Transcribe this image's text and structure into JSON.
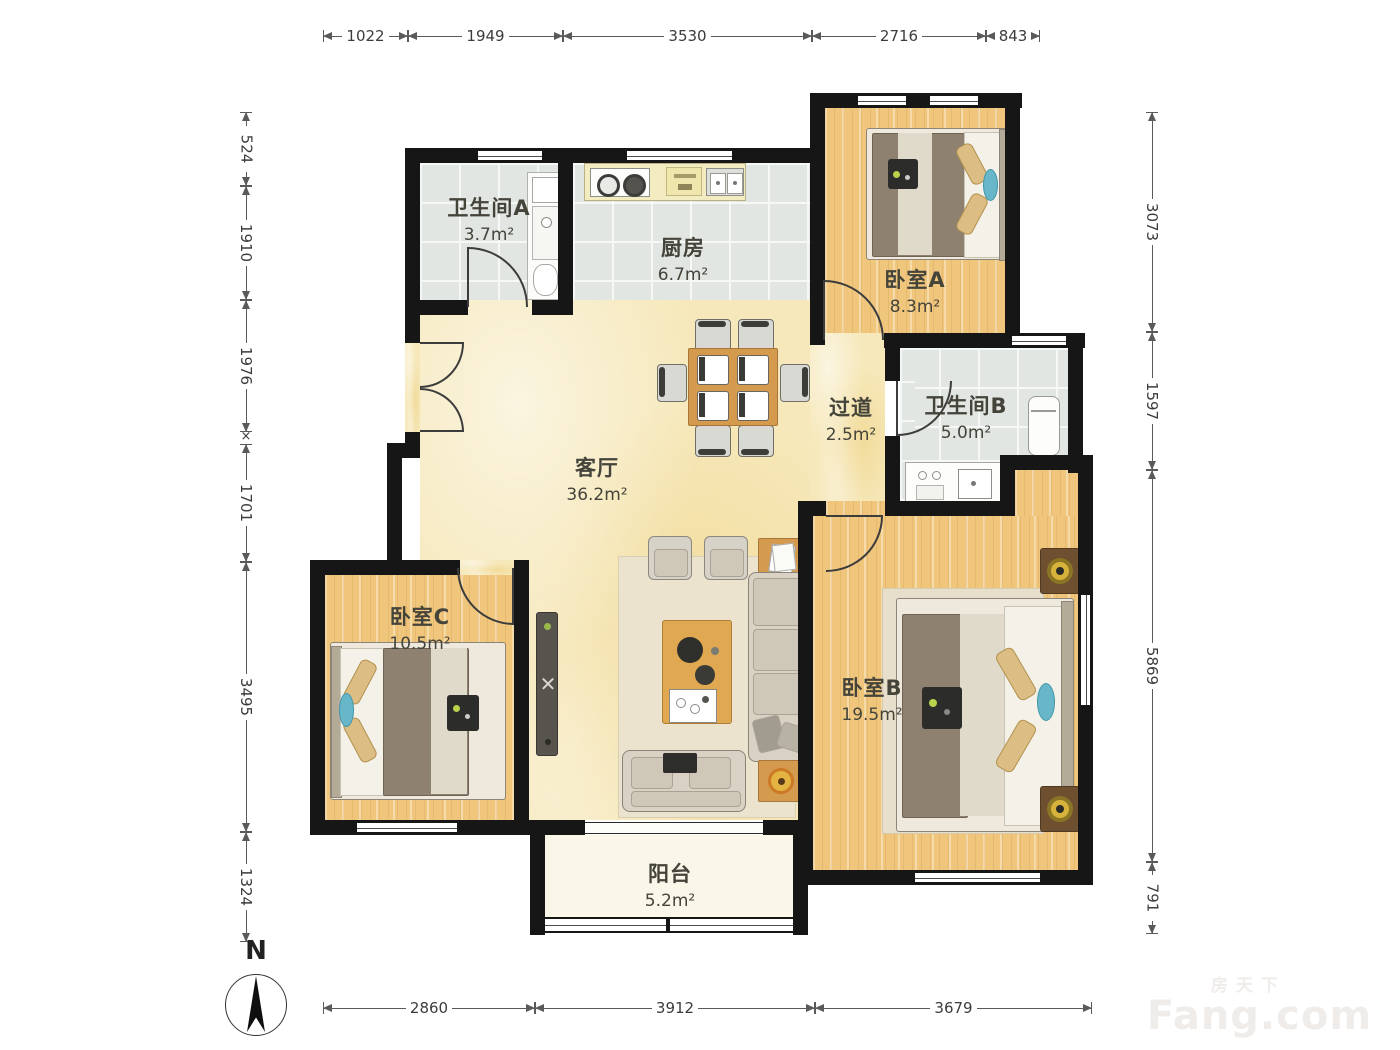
{
  "rooms": [
    {
      "id": "bathroom_a",
      "name": "卫生间A",
      "area": "3.7m²"
    },
    {
      "id": "kitchen",
      "name": "厨房",
      "area": "6.7m²"
    },
    {
      "id": "bedroom_a",
      "name": "卧室A",
      "area": "8.3m²"
    },
    {
      "id": "hallway",
      "name": "过道",
      "area": "2.5m²"
    },
    {
      "id": "bathroom_b",
      "name": "卫生间B",
      "area": "5.0m²"
    },
    {
      "id": "living_room",
      "name": "客厅",
      "area": "36.2m²"
    },
    {
      "id": "bedroom_c",
      "name": "卧室C",
      "area": "10.5m²"
    },
    {
      "id": "bedroom_b",
      "name": "卧室B",
      "area": "19.5m²"
    },
    {
      "id": "balcony",
      "name": "阳台",
      "area": "5.2m²"
    }
  ],
  "dimensions": {
    "top": [
      "1022",
      "1949",
      "3530",
      "2716",
      "843"
    ],
    "left": [
      "524",
      "1910",
      "1976",
      "1701",
      "3495",
      "1324"
    ],
    "right": [
      "3073",
      "1597",
      "5869",
      "791"
    ],
    "bottom": [
      "2860",
      "3912",
      "3679"
    ],
    "x_mark": "×"
  },
  "compass": {
    "label": "N"
  },
  "watermark": {
    "brand_cn": "房天下",
    "brand_en": "Fang.com"
  },
  "colors": {
    "wall": "#161616",
    "wood_floor": "#f0c67d",
    "tile_floor": "#e2e6e2",
    "living_floor": "#f6e8ba",
    "furniture_wood": "#d49b4e",
    "teal_accent": "#67b7c9",
    "dimension_text": "#3c3c3c"
  }
}
